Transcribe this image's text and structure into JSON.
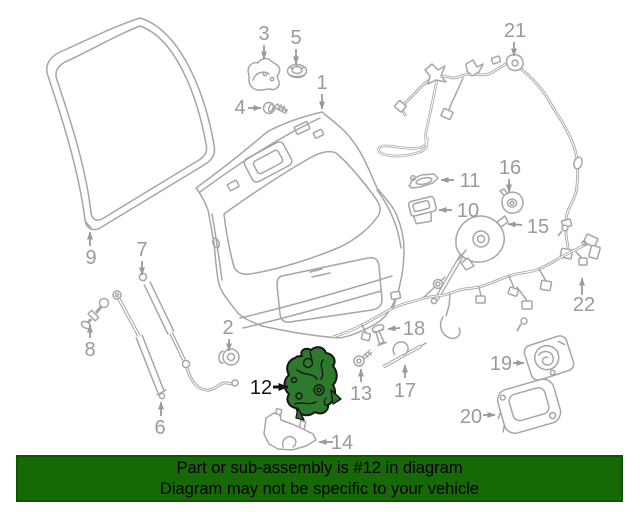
{
  "banner": {
    "line1": "Part or sub-assembly is #12 in diagram",
    "line2": "Diagram may not be specific to your vehicle",
    "background": "#166906",
    "border_color": "#0e5403",
    "text_color": "#000000"
  },
  "diagram": {
    "highlighted_part": "12",
    "highlight_fill": "#2d7a2e",
    "highlight_outline": "#151515",
    "line_color": "#a6a6a6",
    "label_color": "#9a9a9a",
    "background": "#ffffff",
    "labels": [
      {
        "text": "1",
        "x": 322,
        "y": 89,
        "arrow": [
          322,
          94,
          322,
          109
        ]
      },
      {
        "text": "2",
        "x": 228,
        "y": 334,
        "arrow": [
          229,
          339,
          229,
          351
        ]
      },
      {
        "text": "3",
        "x": 264,
        "y": 40,
        "arrow": [
          264,
          45,
          264,
          59
        ]
      },
      {
        "text": "4",
        "x": 240,
        "y": 114,
        "arrow": [
          248,
          108,
          261,
          108
        ]
      },
      {
        "text": "5",
        "x": 296,
        "y": 44,
        "arrow": [
          296,
          49,
          296,
          64
        ]
      },
      {
        "text": "6",
        "x": 160,
        "y": 434,
        "arrow": [
          161,
          416,
          161,
          402
        ]
      },
      {
        "text": "7",
        "x": 142,
        "y": 256,
        "arrow": [
          142,
          261,
          142,
          275
        ]
      },
      {
        "text": "8",
        "x": 90,
        "y": 356,
        "arrow": [
          90,
          338,
          90,
          325
        ]
      },
      {
        "text": "9",
        "x": 91,
        "y": 264,
        "arrow": [
          90,
          246,
          90,
          232
        ]
      },
      {
        "text": "10",
        "x": 468,
        "y": 217,
        "arrow": [
          452,
          210,
          439,
          210
        ]
      },
      {
        "text": "11",
        "x": 470,
        "y": 187,
        "arrow": [
          454,
          180,
          441,
          180
        ]
      },
      {
        "text": "12",
        "x": 261,
        "y": 394,
        "arrow": [
          273,
          387,
          288,
          387
        ],
        "highlight": true
      },
      {
        "text": "13",
        "x": 361,
        "y": 400,
        "arrow": [
          361,
          382,
          361,
          369
        ]
      },
      {
        "text": "14",
        "x": 342,
        "y": 449,
        "arrow": [
          333,
          442,
          319,
          442
        ]
      },
      {
        "text": "15",
        "x": 538,
        "y": 233,
        "arrow": [
          522,
          225,
          508,
          224
        ]
      },
      {
        "text": "16",
        "x": 510,
        "y": 174,
        "arrow": [
          509,
          179,
          509,
          192
        ]
      },
      {
        "text": "17",
        "x": 405,
        "y": 397,
        "arrow": [
          405,
          378,
          405,
          365
        ]
      },
      {
        "text": "18",
        "x": 414,
        "y": 335,
        "arrow": [
          400,
          328,
          388,
          329
        ]
      },
      {
        "text": "19",
        "x": 501,
        "y": 370,
        "arrow": [
          513,
          363,
          524,
          363
        ]
      },
      {
        "text": "20",
        "x": 471,
        "y": 423,
        "arrow": [
          483,
          415,
          495,
          415
        ]
      },
      {
        "text": "21",
        "x": 515,
        "y": 37,
        "arrow": [
          514,
          42,
          514,
          56
        ]
      },
      {
        "text": "22",
        "x": 584,
        "y": 311,
        "arrow": [
          582,
          295,
          582,
          278
        ]
      }
    ]
  }
}
